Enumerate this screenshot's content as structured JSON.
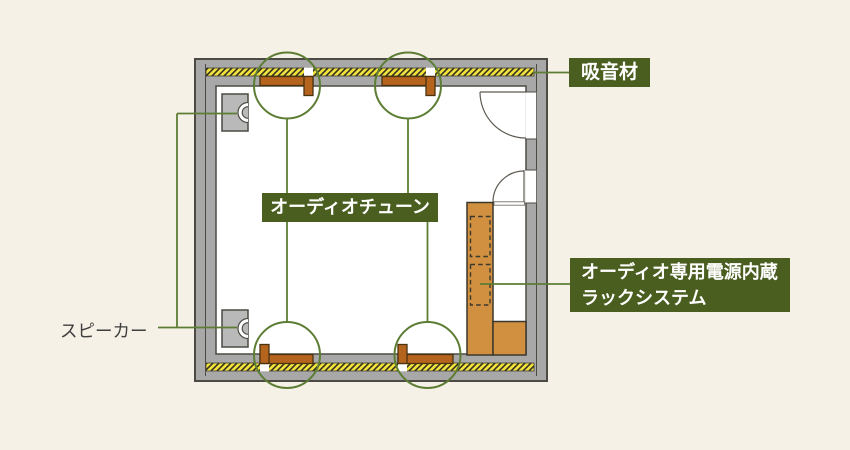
{
  "labels": {
    "absorber": "吸音材",
    "audio_tune": "オーディオチューン",
    "rack_line1": "オーディオ専用電源内蔵",
    "rack_line2": "ラックシステム",
    "speaker": "スピーカー"
  },
  "colors": {
    "background": "#f6f1e7",
    "label_green": "#4a5e20",
    "line_green": "#5c7d33",
    "wall_gray": "#a8a8a8",
    "wall_outline": "#4d4a43",
    "absorber_yellow": "#f2e33c",
    "tune_brown": "#b5641e",
    "rack_orange": "#d0903f",
    "speaker_gray": "#b9b9b9",
    "text_dark": "#3f3f3f"
  }
}
